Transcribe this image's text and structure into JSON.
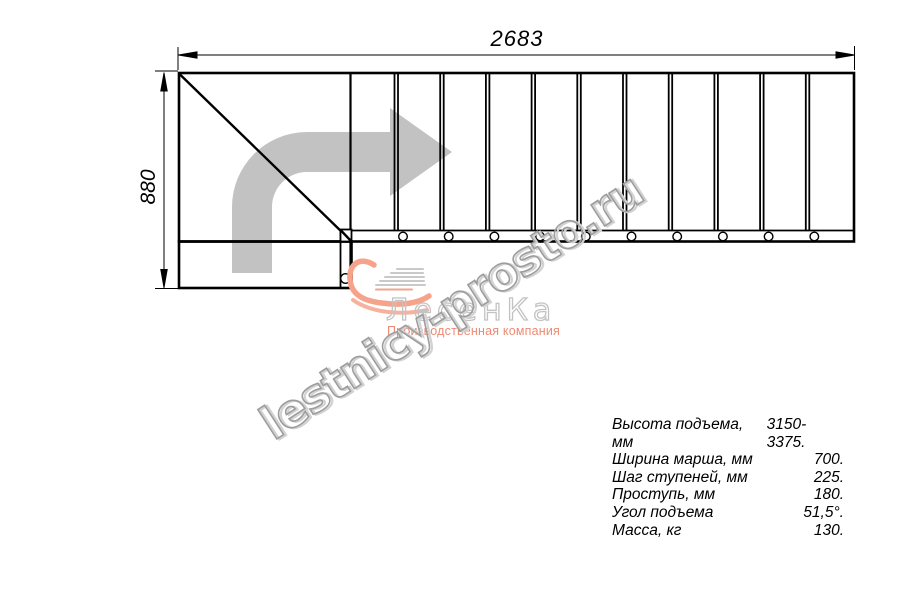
{
  "drawing": {
    "type": "staircase-plan-top-view",
    "dim_width_mm": "2683",
    "dim_height_mm": "880",
    "step_count": 11,
    "steps": {
      "interior_lines": 10,
      "first_x": 394.5,
      "spacing": 45.7,
      "top_y": 72,
      "bottom_y": 230,
      "pair_gap": 3.5,
      "line_width": 1.8,
      "bolt_dx": 8.5,
      "bolt_y": 236.5,
      "bolt_r": 4.3
    }
  },
  "watermark": {
    "text": "lestnicy-prosto.ru"
  },
  "logo": {
    "name": "ЛесенКа",
    "tagline": "Производственная компания"
  },
  "specs": {
    "rows": [
      {
        "label": "Высота подъема, мм",
        "value": "3150-3375."
      },
      {
        "label": "Ширина марша, мм",
        "value": "700."
      },
      {
        "label": "Шаг ступеней, мм",
        "value": "225."
      },
      {
        "label": "Проступь, мм",
        "value": "180."
      },
      {
        "label": "Угол подъема",
        "value": "51,5°."
      },
      {
        "label": "Масса, кг",
        "value": "130."
      }
    ]
  },
  "colors": {
    "line": "#000000",
    "direction_arrow": "#c2c2c2",
    "watermark_outline": "#9d9d9d",
    "watermark_emboss": "#d2d2d2",
    "logo_name_gray": "#c3c3c3",
    "logo_accent": "#ee8a73",
    "swoosh_salmon": "#f5a38b"
  }
}
